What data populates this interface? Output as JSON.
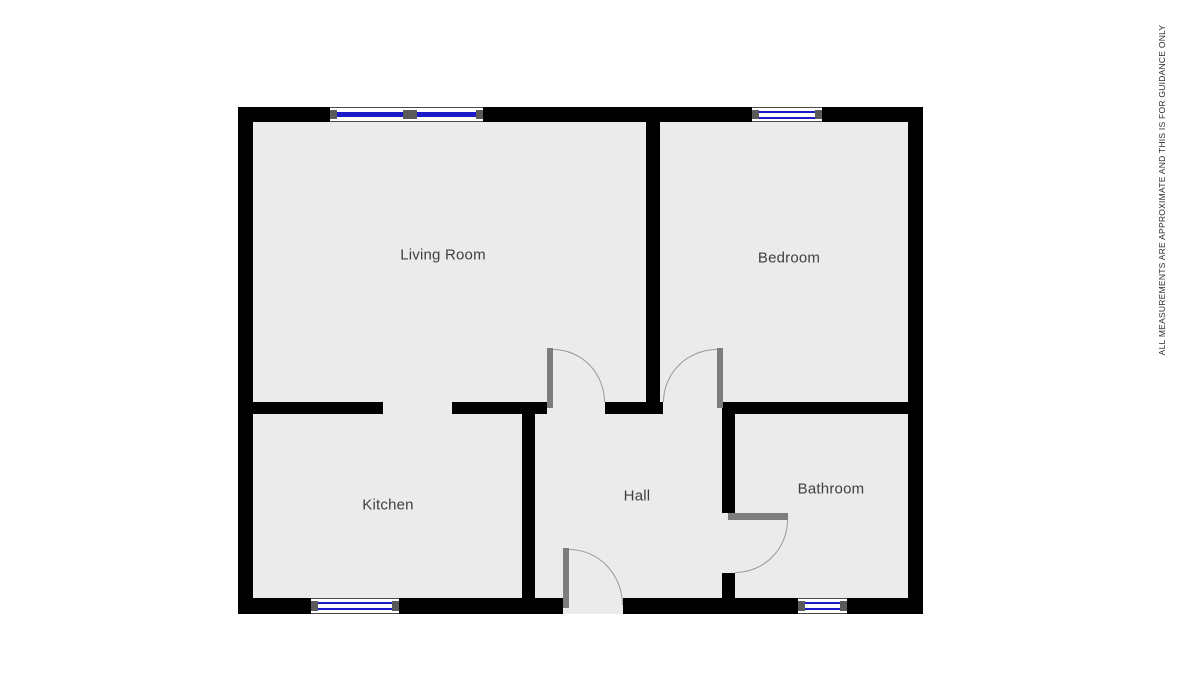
{
  "disclaimer": {
    "text": "ALL MEASUREMENTS ARE APPROXIMATE AND THIS IS FOR GUIDANCE ONLY"
  },
  "floorplan": {
    "rooms": [
      {
        "id": "living-room",
        "label": "Living Room"
      },
      {
        "id": "bedroom",
        "label": "Bedroom"
      },
      {
        "id": "kitchen",
        "label": "Kitchen"
      },
      {
        "id": "hall",
        "label": "Hall"
      },
      {
        "id": "bathroom",
        "label": "Bathroom"
      }
    ],
    "features": {
      "windows": 5,
      "doors_with_swing": 4,
      "open_doorways": 1
    },
    "colors": {
      "wall": "#000000",
      "floor": "#ebebeb",
      "window_frame": "#ffffff",
      "window_frame_edge": "#5a5a5a",
      "window_glass": "#1a1ac8",
      "door_leaf": "#7d7d7d",
      "door_arc": "#9a9a9a",
      "label_text": "#3f3f3f",
      "disclaimer_text": "#2b2b2b"
    }
  }
}
